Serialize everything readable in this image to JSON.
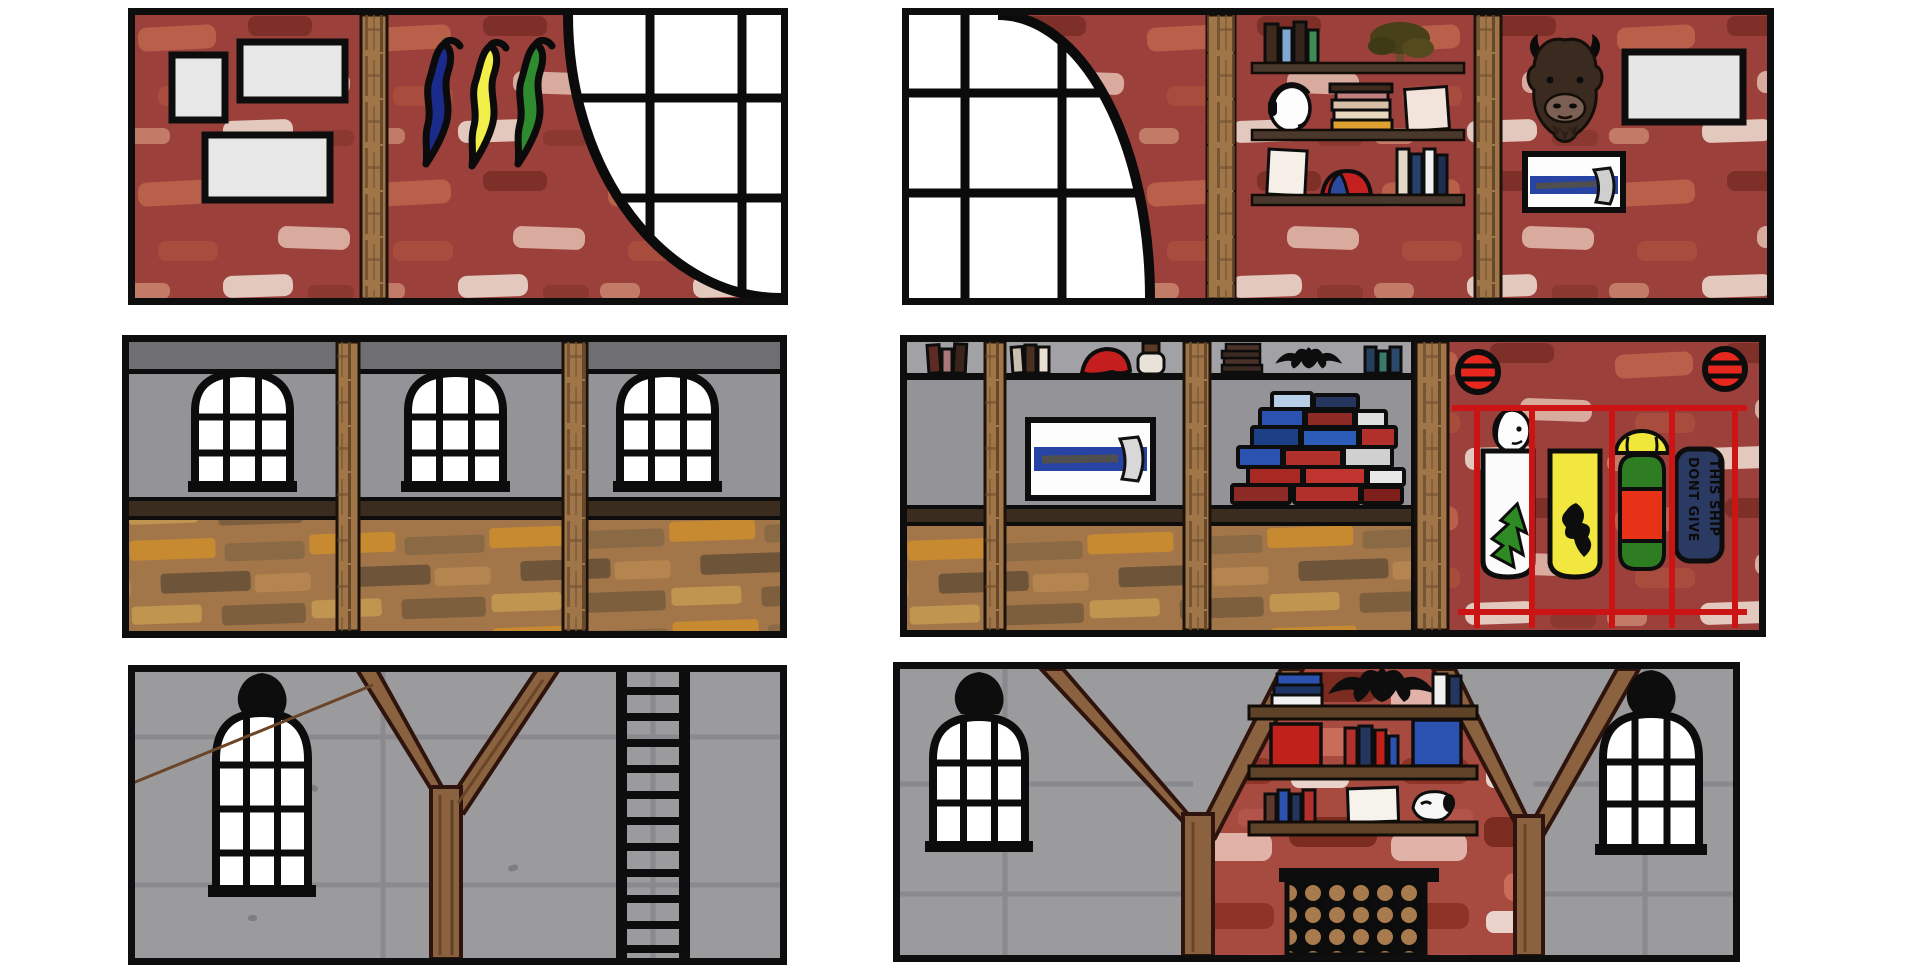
{
  "scene": {
    "kind": "hand-drawn-interior-wall-concept-sheet",
    "panel_count": 6
  },
  "sign": {
    "line1": "DONT GIVE",
    "line2": "THIS SHIP"
  },
  "colors": {
    "brick_base": "#9c403c",
    "brick_base_bold": "#a74b41",
    "wall_gray": "#949498",
    "attic_gray": "#9b9b9d",
    "strip_dark_gray": "#6f6f73",
    "strip_light_gray": "#a2a2a6",
    "wood_beam": "#a07648",
    "shelf_brown": "#5f4329",
    "rail_brown": "#3a2c1f",
    "floor_base": "#a3764a",
    "outline_black": "#0d0d0d",
    "window_white": "#ffffff",
    "cage_red": "#cc1414",
    "porthole_red": "#e8281e",
    "pennant_blue": "#1b2b8c",
    "pennant_yellow": "#f2ef4a",
    "pennant_green": "#2e8b2e",
    "banner_white": "#fbfbfb",
    "banner_yellow": "#f2e73e",
    "banner_tree_green": "#2e8b24",
    "totem_red": "#e83218",
    "totem_green": "#2e7d22",
    "helmet_yellow": "#efe73a",
    "sign_navy": "#2b3a63",
    "display_blue": "#2743a4",
    "axe_gray": "#d2d2d2",
    "bison_brown": "#3a2a20",
    "log_tan": "#a87b4e",
    "book_red": "#b2302c",
    "book_blue": "#2b52b0",
    "book_navy": "#24365e"
  },
  "panels": [
    {
      "id": "top-left",
      "wall": "red-brick",
      "objects": [
        "picture-frame",
        "picture-frame",
        "picture-frame",
        "wood-beam",
        "pennant-blue",
        "pennant-yellow",
        "pennant-green",
        "arched-corner-window"
      ]
    },
    {
      "id": "top-right",
      "wall": "red-brick",
      "objects": [
        "arched-corner-window",
        "wood-beam",
        "wall-shelves",
        "books",
        "potted-bonsai",
        "skull-with-headphones",
        "book-stack",
        "paper-sheet",
        "beanie-cap",
        "wood-beam",
        "bison-head-trophy",
        "picture-frame",
        "axe-display-case"
      ]
    },
    {
      "id": "middle-left",
      "wall": "gray-plaster",
      "objects": [
        "arched-window",
        "arched-window",
        "arched-window",
        "wood-beam",
        "wood-beam",
        "plank-floor"
      ]
    },
    {
      "id": "middle-right",
      "wall": "gray-cabinets-and-red-brick",
      "objects": [
        "top-shelf-books",
        "red-cap",
        "jug",
        "book-stack",
        "eagle-figure",
        "axe-display-case",
        "brick-pile",
        "porthole-lamp",
        "porthole-lamp",
        "red-cage",
        "white-banner-pine-tree",
        "mounted-skull",
        "yellow-banner-bird",
        "totem-with-helmet",
        "navy-sign",
        "plank-floor"
      ]
    },
    {
      "id": "bottom-left",
      "wall": "gray-attic",
      "objects": [
        "black-lamp",
        "arched-window",
        "y-shaped-tree-post",
        "ladder"
      ]
    },
    {
      "id": "bottom-right",
      "wall": "gray-attic-with-red-brick-center",
      "objects": [
        "black-lamp",
        "arched-window",
        "y-shaped-tree-post",
        "bookshelf",
        "eagle-silhouette",
        "books",
        "paper-sheet",
        "animal-skull",
        "firewood-stack",
        "y-shaped-tree-post",
        "arched-window",
        "black-lamp"
      ]
    }
  ]
}
